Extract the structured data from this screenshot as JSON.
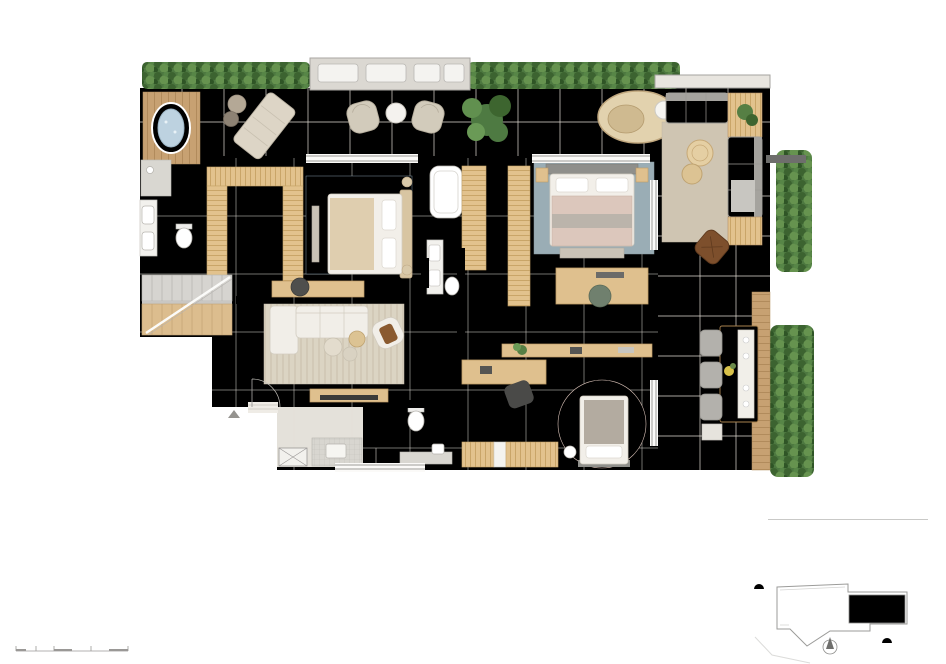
{
  "page": {
    "title": "Opção 02 - Suite Ampliada"
  },
  "notes": {
    "label": "Notas:",
    "items": [
      "1. Os móveis, bancadas de madeira, equipamentos, divisórias, vegetação e objetos decorativos são sugestões de decoração, não fazendo parte integrante do contrato.",
      "2. Os acabamentos em suas cores e formas são ilustrativos e estão especificados no memorial descritivo.",
      "3. O projeto poderá sofrer variações em pilares, vigas, instalações elétricas e hidráulicas, decorrentes de exigências técnicas, estruturais ou das posturas municipais e de concessionárias ou de condições do entorno, verificadas no decorrer da obra.",
      "4. As cotas representadas são acabadas de parede a parede, ou seja, consideram o revestimento especificado para cada ambiente, conforme descrito na NBR 1544 da ABNT.",
      "5. A área total indicada na planta é privativa, ou seja, tomada pelas linhas externas da fachada e das divisas com as áreas comuns e pelos eixos das paredes divisórias entre apartamentos, conforme descrito na NBR 12.721 da ABNT.",
      "6. Poderá haver variação em elementos decorativos, abas e cores da fachada nas varandas em função do pavimento ou coluna, verificar imagens e/ou maquete.",
      "7. A unidade será entregue com infraestrutura para instalação de ar condicionado tipo split ou multi-split, as evaporadoras e condensadoras poderão sofrer mudanças de posição ou quantidade, caso necessário. Os condensadores ficarão na fachada em laje técnica que está incluída na área privativa da unidade."
    ]
  },
  "scale_bar": {
    "caption": "Escala Gráfica",
    "ticks": [
      {
        "v": "0.5",
        "x": 16
      },
      {
        "v": "1.00",
        "x": 36
      },
      {
        "v": "1.50",
        "x": 54
      },
      {
        "v": "2.50",
        "x": 91
      },
      {
        "v": "5.00",
        "x": 128
      }
    ]
  },
  "apartment": {
    "name": "Apartamento 901",
    "type": "Cobertura",
    "area": "Área Privativa - 416,86m²",
    "floors": "(Pavto inferior + Pavto superior)"
  },
  "keyplan": {
    "street": "RUA SOROCABA",
    "units": [
      "01",
      "02",
      "03"
    ],
    "highlighted": "01"
  },
  "plan": {
    "rooms": [
      {
        "t": "VARANDA",
        "x": 547,
        "y": 128
      },
      {
        "t": "BANHO\nSUITE\nMASTER",
        "x": 175,
        "y": 212
      },
      {
        "t": "CLOSET",
        "x": 256,
        "y": 216
      },
      {
        "t": "SUITE MASTER",
        "x": 347,
        "y": 276
      },
      {
        "t": "BANHO\nSUITE",
        "x": 441,
        "y": 239
      },
      {
        "t": "CLOSET",
        "x": 495,
        "y": 239
      },
      {
        "t": "SUITE",
        "x": 546,
        "y": 277
      },
      {
        "t": "SALA INTIMA",
        "x": 337,
        "y": 363
      },
      {
        "t": "COPA",
        "x": 321,
        "y": 426
      },
      {
        "t": "BANHO\nSUITE",
        "x": 438,
        "y": 427
      },
      {
        "t": "SUITE",
        "x": 519,
        "y": 418
      }
    ],
    "dims": [
      {
        "v": "17.65",
        "x": 459,
        "y": 100
      },
      {
        "v": "2.05",
        "x": 194,
        "y": 173,
        "vert": true
      },
      {
        "v": "1.51",
        "x": 187,
        "y": 265
      },
      {
        "v": "1.98",
        "x": 201,
        "y": 264,
        "vert": true
      },
      {
        "v": "5.59",
        "x": 309,
        "y": 191,
        "vert": true
      },
      {
        "v": "3.79",
        "x": 448,
        "y": 172,
        "vert": true
      },
      {
        "v": "4.71",
        "x": 392,
        "y": 294
      },
      {
        "v": "1.47",
        "x": 444,
        "y": 294
      },
      {
        "v": "5.34",
        "x": 467,
        "y": 355
      },
      {
        "v": "4.79",
        "x": 221,
        "y": 399
      },
      {
        "v": "2.41",
        "x": 281,
        "y": 412
      },
      {
        "v": "1.60",
        "x": 361,
        "y": 413,
        "vert": true
      },
      {
        "v": "2.41",
        "x": 379,
        "y": 412
      },
      {
        "v": "1.60",
        "x": 456,
        "y": 413,
        "vert": true
      },
      {
        "v": "5.25",
        "x": 744,
        "y": 457
      },
      {
        "v": "12.03",
        "x": 757,
        "y": 245,
        "vert": true
      }
    ]
  },
  "colors": {
    "wall": "#5c5c5c",
    "floor": "#e8e4dc",
    "terrace": "#edeae3",
    "bath": "#e0deda",
    "wood": "#c7a172",
    "closet_wood": "#e2c28d",
    "hedge": "#4d7840",
    "rug_blue": "#93a7b1",
    "rug_pink": "#e8d4cb",
    "sofa": "#b9b7b2",
    "dining": "#c79e66",
    "jacuzzi": "#a9c4d6",
    "keyplan_unit": "#c8c8c6",
    "sun": "#e5c13d"
  }
}
